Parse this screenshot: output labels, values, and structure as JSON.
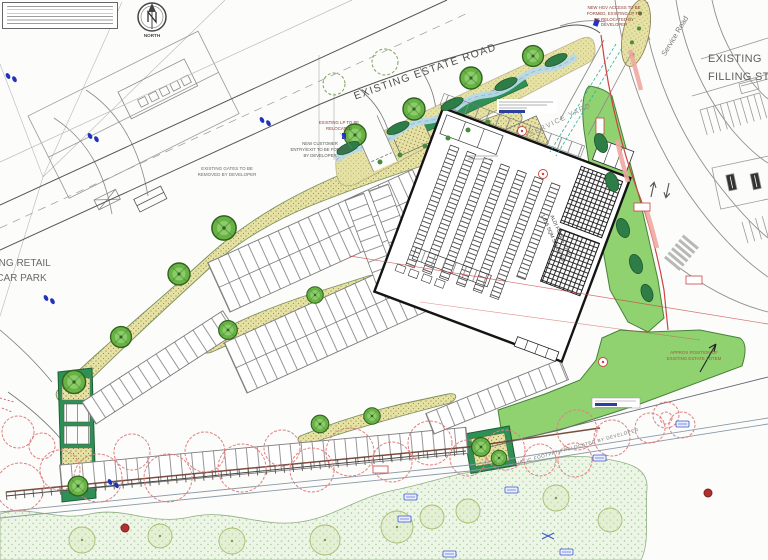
{
  "annotations": {
    "estate_road": "EXISTING ESTATE ROAD",
    "service_road": "Service Road",
    "filling_station": "EXISTING\nFILLING STATION",
    "retail_car_park": "EXISTING RETAIL\nPARK CAR PARK",
    "hgv_note": "NEW HGV ACCESS TO BE\nFORMED, EXISTING LP TO\nBE RELOCATED BY\nDEVELOPER",
    "lp_note": "EXISTING LP TO BE\nRELOCATED",
    "customer_note": "NEW CUSTOMER\nENTRY/EXIT TO BE FORMED\nBY DEVELOPER",
    "gates_note": "EXISTING GATES TO BE\nREMOVED BY DEVELOPER",
    "service_yard": "SERVICE YARD",
    "store": "ALDI FOODSTORE\n1,315 SQM SALES GIA",
    "totem_note": "APPROX POSITION OF\nEXISTING ESTATE TOTEM",
    "footpath_note": "PUBLIC FOOTPATH RELOCATED BY DEVELOPER",
    "north": "NORTH"
  },
  "colors": {
    "landscape_khaki": "#e6e2a4",
    "hedge_green": "#2f9055",
    "lawn_green": "#90d170",
    "tree_green": "#69b345",
    "water_blue": "#b8d9ea",
    "survey_red": "#cc4444",
    "canopy_red": "#e08080",
    "marker_blue": "#3a55c8",
    "stipple_green": "#edf6e6"
  }
}
